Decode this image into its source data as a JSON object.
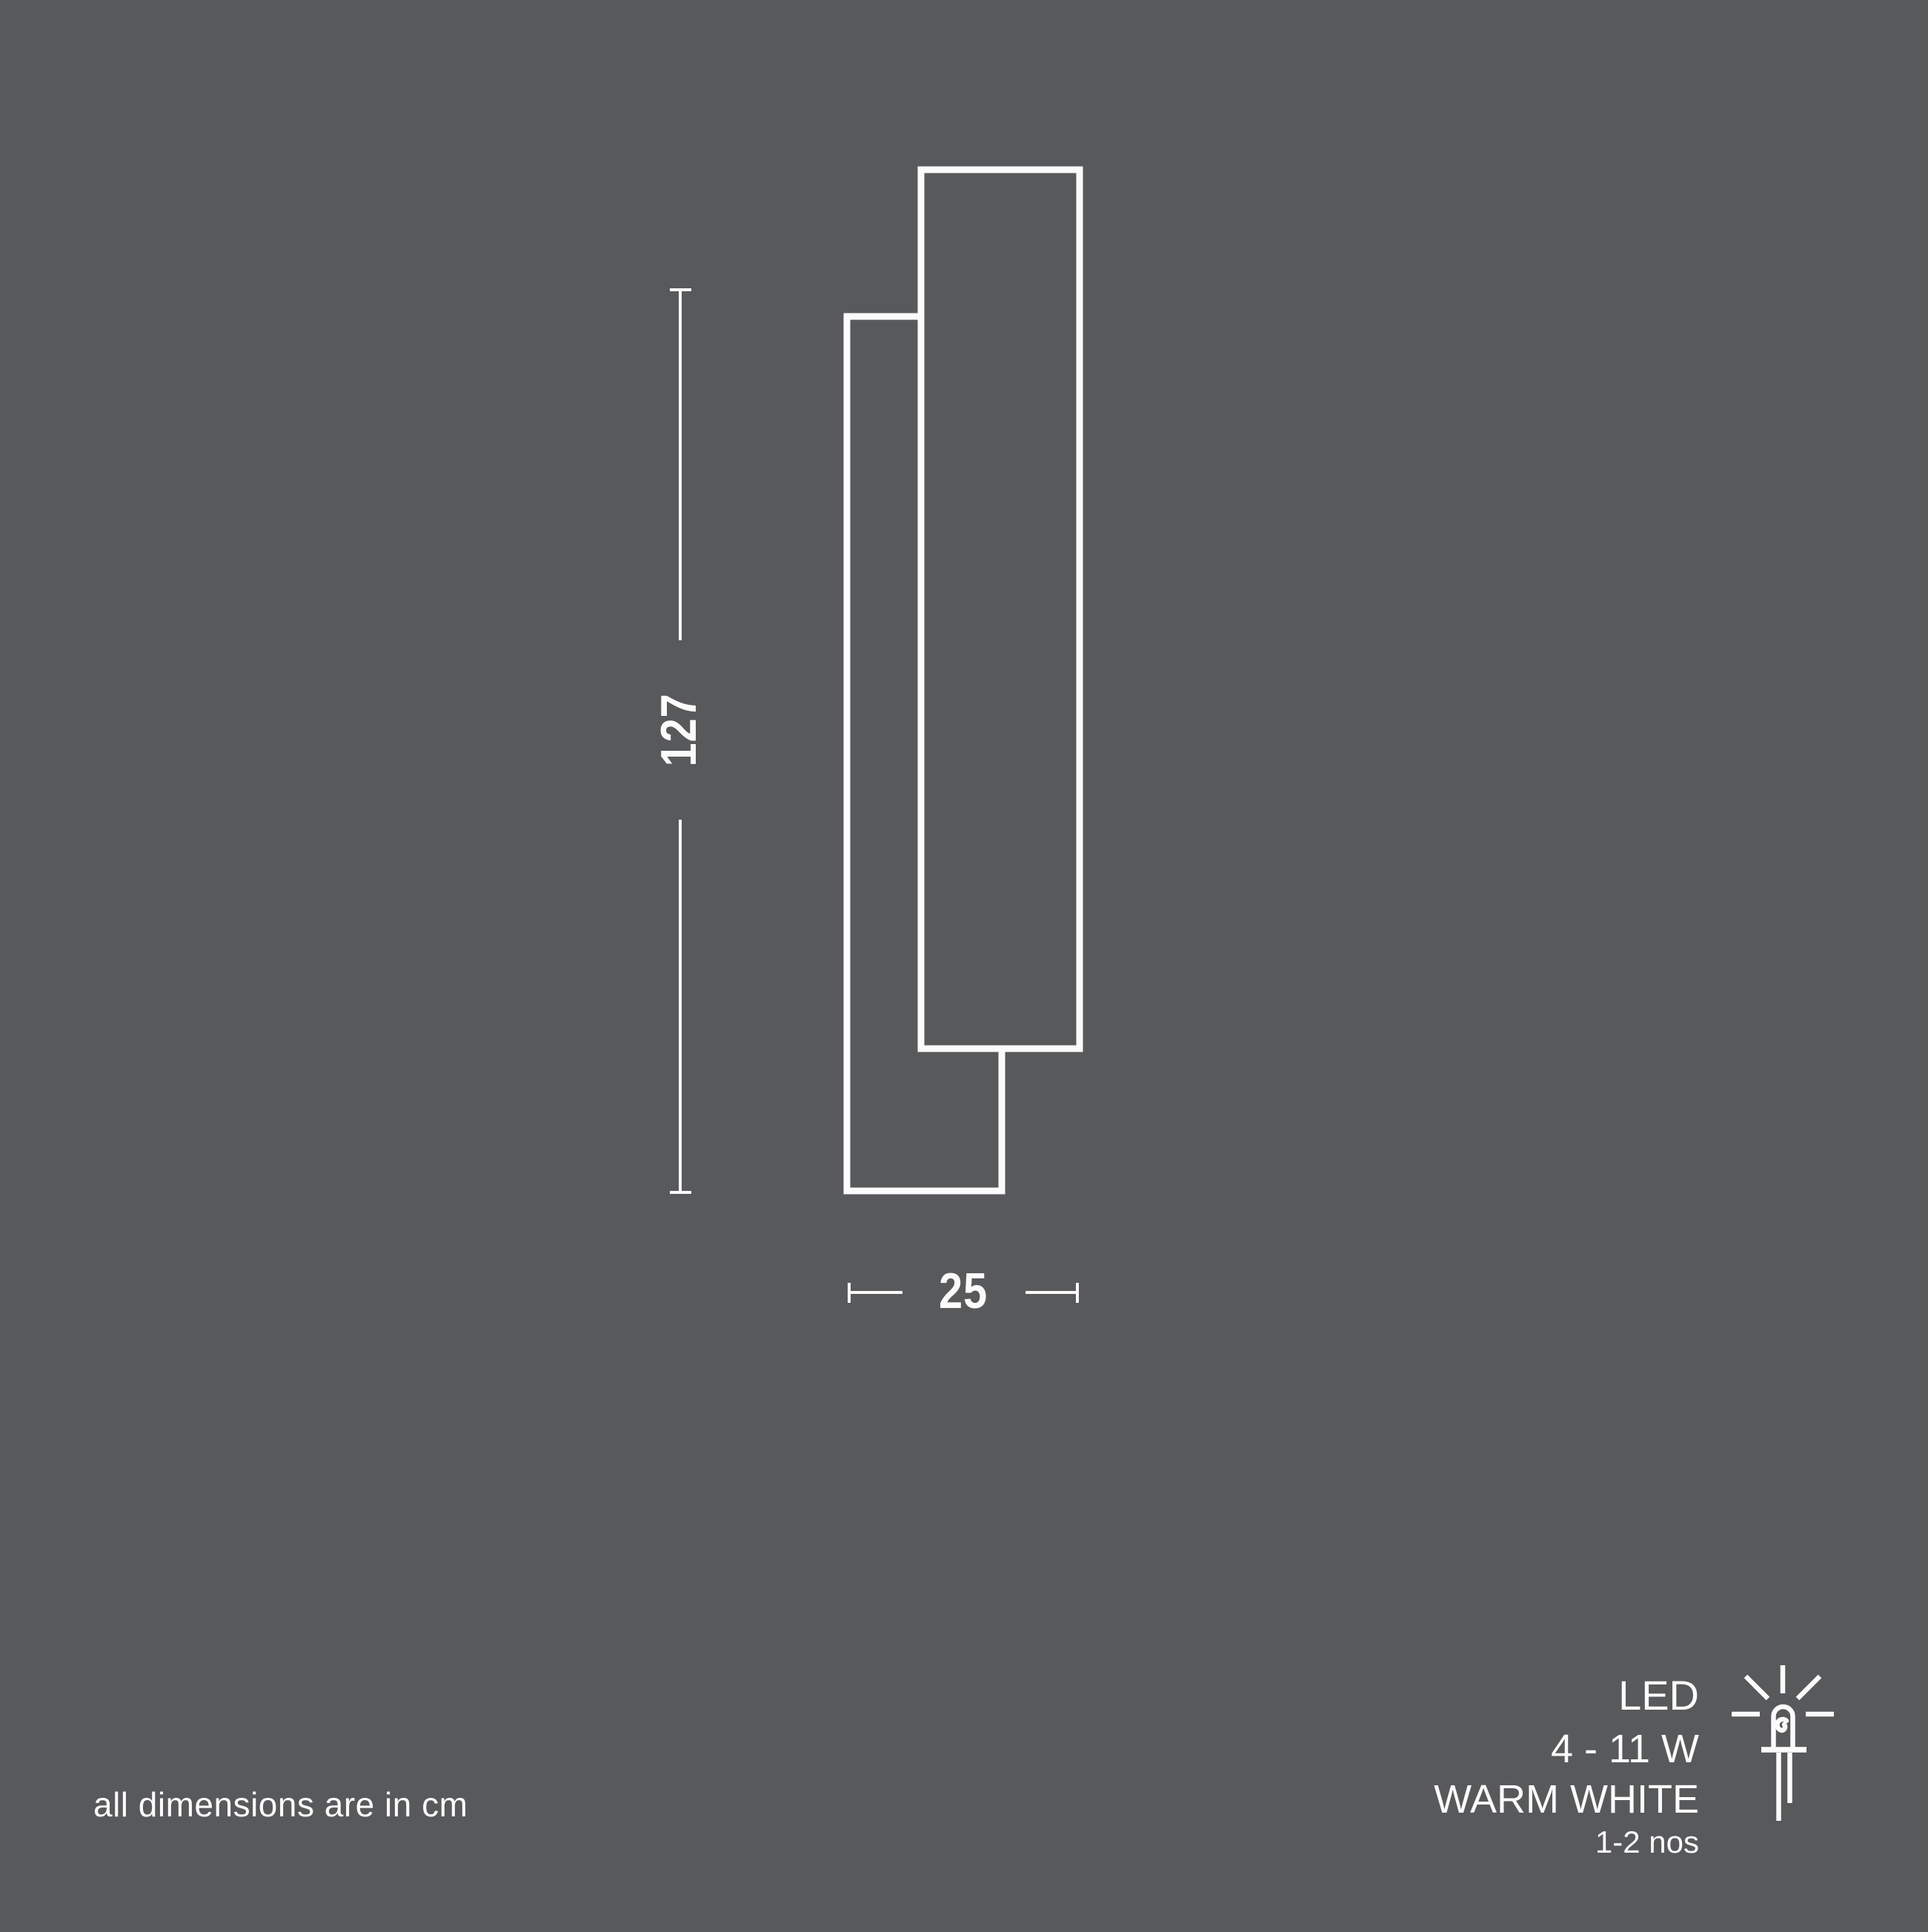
{
  "colors": {
    "background": "#58595b",
    "line": "#fbfbfb"
  },
  "diagram": {
    "height_cm": "127",
    "width_cm": "25"
  },
  "note": "all dimensions are in cm",
  "spec": {
    "lamp_type": "LED",
    "wattage": "4 - 11 W",
    "light_color": "WARM WHITE",
    "quantity": "1-2 nos"
  },
  "icons": {
    "led": "led-bulb-icon"
  }
}
